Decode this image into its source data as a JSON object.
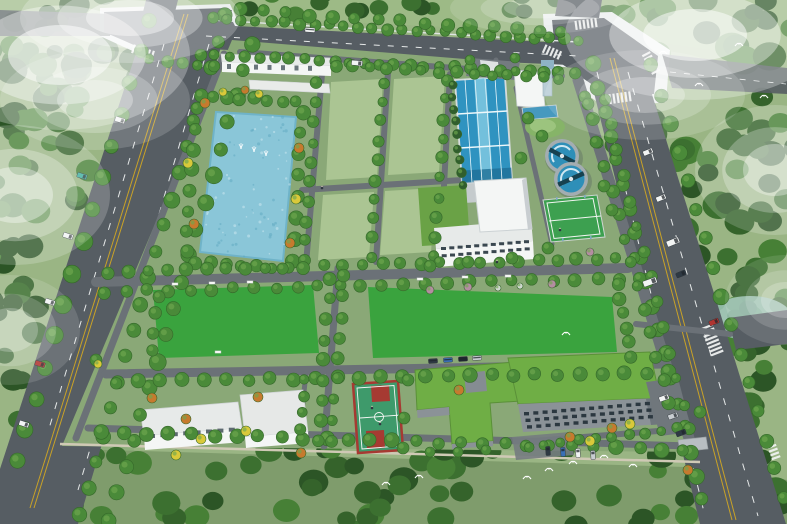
{
  "meta": {
    "description": "Aerial bird's-eye architectural rendering of a planned water treatment plant campus with perimeter roads, pond, lawn plots, sedimentation basin, clarifier tanks, sports courts and buildings",
    "view": "isometric aerial rendering",
    "visible_text": ""
  },
  "colors": {
    "base": "#9ab584",
    "north_grass": "#9dba86",
    "west_strip": "#8fae7c",
    "south_strip": "#7f9c6c",
    "campus_ground": "#8aa877",
    "forest_palette": [
      "#2c5526",
      "#3c7030",
      "#478036",
      "#35632b"
    ],
    "water_forest": "#9fc4b8",
    "road": "#565d63",
    "sidewalk": "#e8ecec",
    "path": "#6b7177",
    "plaza": "#747b80",
    "line_yellow": "#c9a227",
    "line_white": "#e6e9e9",
    "wall": "#cfc9b5",
    "pond": "#8ac6d8",
    "pond_edge": "#6fb3c8",
    "basin_water": "#2f93c0",
    "basin_lane": "#7fc8e0",
    "basin_dark": "#1f6f96",
    "chem_basin": "#4699bf",
    "clarifier_rim": "#a3adb1",
    "clarifier_water": "#2e8fb8",
    "clarifier_bridge": "#17414f",
    "lawn_plot": "#abc593",
    "lawn_vivid": "#3aa33e",
    "mound_outer": "#86b468",
    "mound_inner": "#9cc47e",
    "bldg_white": "#f4f6f5",
    "roof_light": "#e7eae9",
    "roof_shadow": "#c9ced1",
    "facade_grey": "#8b9297",
    "facade_dark": "#6f777d",
    "window_dark": "#2c3840",
    "roof_green": "#6fae45",
    "roof_green_dark": "#5a9038",
    "court_surface": "#3e9a6b",
    "court_red": "#a63a32",
    "sport_green": "#3da050",
    "tree_green": "#4a8a39",
    "tree_dark": "#35682a",
    "tree_light": "#6fa84f",
    "tree_orange": "#c67a2e",
    "tree_yellow": "#d9c93a",
    "shrub_pink": "#b48da1",
    "carport": "#b8bec2",
    "shed_roof": "#7a3b36",
    "bird": "#ffffff",
    "mist": "#ffffff"
  },
  "features": {
    "pond": {
      "label": "landscape pond with fountains",
      "fountain_count": 3
    },
    "clarifiers": {
      "label": "circular clarifier tanks",
      "count": 2
    },
    "sedimentation_basin": {
      "label": "long blue multi-lane treatment basin",
      "count": 1
    },
    "lawn_plots": {
      "label": "reserved light-green lawn plots",
      "count": 4
    },
    "large_lawns": {
      "label": "large vivid green lawns",
      "count": 2
    },
    "basketball_court": {
      "label": "red and green basketball court",
      "count": 1
    },
    "multi_sport_court": {
      "label": "green fenced multi-sport court",
      "count": 1
    },
    "buildings": {
      "label": "white service buildings, green-roof buildings, office building with canopy, gatehouse, filter building with tower",
      "count": 10
    },
    "roads": {
      "label": "tree-lined perimeter roads with X-intersection and zebra crossings"
    },
    "wildlife": {
      "label": "white egrets flying over forest"
    }
  },
  "render": {
    "forest_regions": [
      [
        -15,
        -15,
        175,
        160,
        40,
        8,
        16
      ],
      [
        -15,
        140,
        140,
        200,
        34,
        8,
        15
      ],
      [
        -15,
        330,
        120,
        200,
        30,
        8,
        15
      ],
      [
        40,
        448,
        760,
        85,
        62,
        8,
        15
      ],
      [
        605,
        -15,
        195,
        230,
        52,
        9,
        17
      ],
      [
        620,
        210,
        175,
        235,
        46,
        8,
        15
      ],
      [
        700,
        288,
        95,
        66,
        12,
        6,
        10
      ],
      [
        225,
        -12,
        350,
        28,
        16,
        6,
        10
      ]
    ],
    "tree_rows": [
      [
        225,
        16,
        80,
        514,
        20,
        7
      ],
      [
        252,
        44,
        110,
        520,
        19,
        7.5
      ],
      [
        150,
        20,
        16,
        462,
        15,
        8
      ],
      [
        212,
        18,
        578,
        40,
        26,
        5.5
      ],
      [
        200,
        54,
        574,
        74,
        26,
        5.5
      ],
      [
        592,
        64,
        702,
        500,
        19,
        7
      ],
      [
        652,
        66,
        784,
        498,
        16,
        7
      ],
      [
        240,
        10,
        562,
        32,
        15,
        6.5
      ],
      [
        197,
        108,
        186,
        252,
        8,
        6.5
      ],
      [
        303,
        112,
        292,
        260,
        8,
        6.5
      ],
      [
        212,
        96,
        296,
        102,
        7,
        6
      ],
      [
        196,
        262,
        288,
        268,
        7,
        6
      ],
      [
        317,
        84,
        304,
        260,
        10,
        5.5
      ],
      [
        383,
        82,
        371,
        258,
        10,
        5.5
      ],
      [
        446,
        80,
        435,
        256,
        10,
        5.5
      ],
      [
        108,
        272,
        636,
        258,
        28,
        6
      ],
      [
        104,
        292,
        640,
        278,
        26,
        6
      ],
      [
        116,
        382,
        668,
        372,
        26,
        6.5
      ],
      [
        102,
        432,
        684,
        450,
        27,
        6.5
      ],
      [
        158,
        296,
        152,
        350,
        4,
        6
      ],
      [
        344,
        276,
        332,
        440,
        9,
        6
      ],
      [
        330,
        278,
        318,
        442,
        9,
        6
      ],
      [
        618,
        284,
        630,
        356,
        6,
        6
      ],
      [
        586,
        96,
        676,
        428,
        15,
        6
      ],
      [
        604,
        100,
        690,
        430,
        14,
        5.5
      ],
      [
        452,
        84,
        462,
        186,
        9,
        4.5,
        "#315e2d"
      ],
      [
        528,
        446,
        662,
        432,
        9,
        5
      ],
      [
        305,
        380,
        299,
        430,
        4,
        5.5
      ],
      [
        336,
        66,
        560,
        78,
        14,
        5.5
      ],
      [
        150,
        60,
        215,
        66,
        5,
        5.5
      ]
    ],
    "tree_singles": [
      [
        528,
        118,
        6
      ],
      [
        542,
        136,
        6
      ],
      [
        521,
        158,
        6
      ],
      [
        596,
        142,
        6
      ],
      [
        604,
        186,
        6
      ],
      [
        588,
        104,
        6
      ],
      [
        612,
        210,
        6
      ],
      [
        548,
        248,
        6
      ],
      [
        470,
        60,
        5
      ],
      [
        515,
        58,
        5
      ],
      [
        430,
        266,
        6
      ],
      [
        468,
        262,
        6
      ],
      [
        512,
        258,
        6
      ],
      [
        408,
        380,
        6
      ],
      [
        404,
        418,
        6
      ],
      [
        403,
        448,
        6
      ],
      [
        430,
        452,
        5
      ],
      [
        458,
        452,
        5
      ],
      [
        486,
        450,
        5
      ],
      [
        700,
        412,
        6
      ],
      [
        650,
        332,
        6
      ],
      [
        96,
        360,
        6
      ],
      [
        205,
        103,
        5,
        "#c67a2e"
      ],
      [
        299,
        148,
        5,
        "#c67a2e"
      ],
      [
        194,
        224,
        5,
        "#c67a2e"
      ],
      [
        290,
        243,
        5,
        "#c67a2e"
      ],
      [
        152,
        398,
        5,
        "#c67a2e"
      ],
      [
        186,
        419,
        5,
        "#c67a2e"
      ],
      [
        258,
        397,
        5,
        "#c67a2e"
      ],
      [
        301,
        453,
        5,
        "#c67a2e"
      ],
      [
        459,
        390,
        5,
        "#c67a2e"
      ],
      [
        570,
        437,
        5,
        "#c67a2e"
      ],
      [
        612,
        428,
        5,
        "#c67a2e"
      ],
      [
        688,
        470,
        5,
        "#c67a2e"
      ],
      [
        245,
        90,
        4,
        "#c67a2e"
      ],
      [
        188,
        163,
        5,
        "#d9c93a"
      ],
      [
        296,
        199,
        5,
        "#d9c93a"
      ],
      [
        259,
        94,
        4,
        "#d9c93a"
      ],
      [
        201,
        439,
        5,
        "#d9c93a"
      ],
      [
        246,
        431,
        5,
        "#d9c93a"
      ],
      [
        590,
        441,
        5,
        "#d9c93a"
      ],
      [
        630,
        424,
        5,
        "#d9c93a"
      ],
      [
        176,
        455,
        5,
        "#d9c93a"
      ],
      [
        98,
        364,
        4,
        "#d9c93a"
      ],
      [
        223,
        92,
        4,
        "#d9c93a"
      ],
      [
        468,
        287,
        4,
        "#b48da1"
      ],
      [
        552,
        284,
        4,
        "#b48da1"
      ],
      [
        430,
        290,
        4,
        "#b48da1"
      ],
      [
        590,
        252,
        4,
        "#b48da1"
      ],
      [
        498,
        288,
        3,
        "#cfd8cf"
      ],
      [
        520,
        286,
        3,
        "#cfd8cf"
      ]
    ],
    "speckle_pond": {
      "quad": [
        216,
        112,
        296,
        117,
        283,
        261,
        200,
        252
      ],
      "n": 80,
      "fills": [
        "#cfeaf2",
        "#5ea8c0"
      ]
    },
    "cars": [
      [
        120,
        120,
        108,
        "#f2f4f4"
      ],
      [
        82,
        176,
        108,
        "#3fae9e"
      ],
      [
        68,
        236,
        108,
        "#f2f4f4"
      ],
      [
        50,
        302,
        108,
        "#f2f4f4"
      ],
      [
        40,
        364,
        108,
        "#b03430"
      ],
      [
        24,
        424,
        108,
        "#f2f4f4"
      ],
      [
        648,
        152,
        68,
        "#f2f4f4"
      ],
      [
        661,
        198,
        68,
        "#f2f4f4"
      ],
      [
        673,
        242,
        68,
        "#f2f4f4",
        6,
        13
      ],
      [
        681,
        274,
        68,
        "#2e3943"
      ],
      [
        714,
        322,
        68,
        "#b03430"
      ],
      [
        664,
        398,
        70,
        "#f2f4f4"
      ],
      [
        673,
        416,
        70,
        "#c8cdd1"
      ],
      [
        681,
        433,
        70,
        "#2e3943"
      ],
      [
        563,
        452,
        -4,
        "#3a6fb5",
        4.5,
        9
      ],
      [
        578,
        453,
        -4,
        "#f2f4f4",
        4.5,
        9
      ],
      [
        593,
        455,
        -4,
        "#c8cdd1",
        4.5,
        9
      ],
      [
        548,
        451,
        -4,
        "#2e3943",
        4.5,
        9
      ],
      [
        433,
        361,
        -4,
        "#2e3943",
        9,
        4.5
      ],
      [
        448,
        360,
        -4,
        "#3a6fb5",
        9,
        4.5
      ],
      [
        463,
        359,
        -4,
        "#1f2730",
        9,
        4.5
      ],
      [
        477,
        358,
        -4,
        "#c8cdd1",
        9,
        4.5
      ],
      [
        357,
        63,
        95,
        "#f2f4f4",
        5,
        11
      ],
      [
        650,
        282,
        70,
        "#f2f4f4",
        6,
        14
      ],
      [
        310,
        30,
        4,
        "#f2f4f4",
        10,
        4.5
      ]
    ],
    "zebras": [
      [
        586,
        24,
        -8,
        6,
        9
      ],
      [
        552,
        52,
        24,
        5,
        9
      ],
      [
        618,
        98,
        -8,
        7,
        10
      ],
      [
        651,
        63,
        62,
        6,
        9
      ],
      [
        143,
        52,
        18,
        6,
        9
      ],
      [
        712,
        340,
        68,
        8,
        13
      ],
      [
        774,
        452,
        70,
        4,
        9
      ]
    ],
    "benches": [
      [
        175,
        284
      ],
      [
        212,
        283
      ],
      [
        250,
        282
      ],
      [
        420,
        279
      ],
      [
        465,
        277
      ],
      [
        508,
        276
      ],
      [
        218,
        352
      ]
    ],
    "people": [
      [
        372,
        408
      ],
      [
        380,
        424
      ],
      [
        322,
        188
      ],
      [
        497,
        262
      ],
      [
        560,
        230
      ]
    ],
    "fountains": [
      [
        241,
        148
      ],
      [
        254,
        151
      ],
      [
        266,
        155
      ]
    ],
    "birds": [
      [
        527,
        477
      ],
      [
        549,
        469
      ],
      [
        573,
        462
      ],
      [
        604,
        456
      ],
      [
        633,
        465
      ],
      [
        386,
        483
      ],
      [
        419,
        476
      ],
      [
        663,
        52
      ],
      [
        699,
        84
      ],
      [
        739,
        44
      ],
      [
        764,
        96
      ],
      [
        566,
        333
      ]
    ],
    "windows": [
      {
        "x0": 524,
        "y0": 412,
        "cols": 14,
        "rows": 3,
        "dx": 9.3,
        "dy": 6.6,
        "cdy": -0.78,
        "rdx": 1.5,
        "w": 5,
        "h": 3.4,
        "fill": "#2c3840"
      },
      {
        "x0": 441,
        "y0": 247,
        "cols": 11,
        "rows": 2,
        "dx": 8.3,
        "dy": 7.2,
        "cdy": -0.68,
        "rdx": 0.7,
        "w": 5,
        "h": 3,
        "fill": "#3a4750"
      },
      {
        "x0": 149,
        "y0": 434,
        "cols": 8,
        "rows": 1,
        "dx": 11.4,
        "dy": 0,
        "cdy": -0.9,
        "rdx": 0,
        "w": 6,
        "h": 4,
        "fill": "#5d6a70"
      },
      {
        "x0": 227,
        "y0": 64,
        "cols": 7,
        "rows": 1,
        "dx": 13.5,
        "dy": 0,
        "cdy": 0.3,
        "rdx": 0,
        "w": 4,
        "h": 5,
        "fill": "#6a767c"
      }
    ],
    "mist": [
      [
        60,
        55,
        130,
        75,
        0.85
      ],
      [
        15,
        195,
        95,
        70,
        0.6
      ],
      [
        130,
        18,
        110,
        45,
        0.7
      ],
      [
        95,
        100,
        95,
        50,
        0.5
      ],
      [
        695,
        35,
        130,
        65,
        0.85
      ],
      [
        775,
        170,
        80,
        65,
        0.55
      ],
      [
        645,
        95,
        100,
        45,
        0.45
      ],
      [
        540,
        8,
        90,
        26,
        0.4
      ],
      [
        10,
        330,
        70,
        55,
        0.4
      ],
      [
        785,
        300,
        60,
        45,
        0.35
      ]
    ]
  }
}
